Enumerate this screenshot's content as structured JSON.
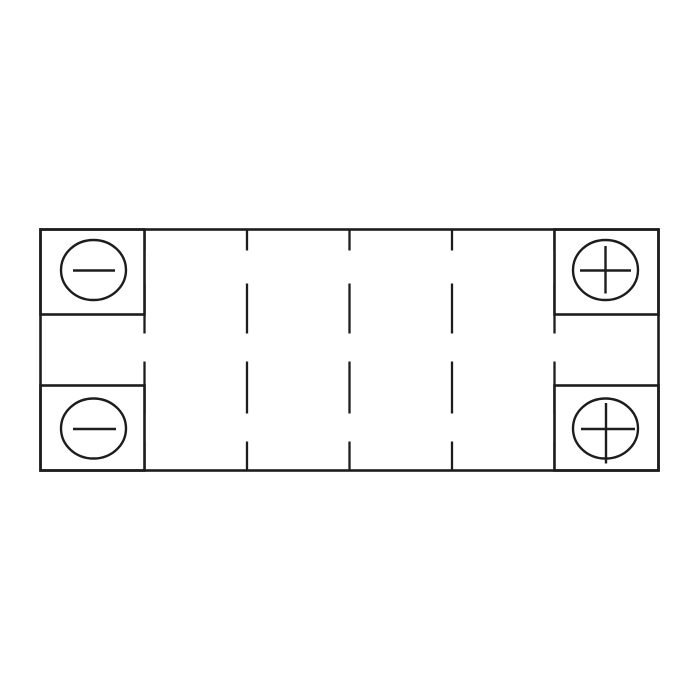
{
  "page": {
    "background_color": "#ffffff"
  },
  "diagram": {
    "kind": "battery-top-view-schematic",
    "line_color": "#1d1d1d",
    "fill_color": "#ffffff",
    "cell_count": 6,
    "cell_divider_count": 5,
    "dash_pattern": "21 33 50 28 52 28 29",
    "terminals": [
      {
        "position": "top-left",
        "polarity": "negative",
        "symbol": "−"
      },
      {
        "position": "bottom-left",
        "polarity": "negative",
        "symbol": "−"
      },
      {
        "position": "top-right",
        "polarity": "positive",
        "symbol": "+"
      },
      {
        "position": "bottom-right",
        "polarity": "positive",
        "symbol": "+"
      }
    ]
  }
}
